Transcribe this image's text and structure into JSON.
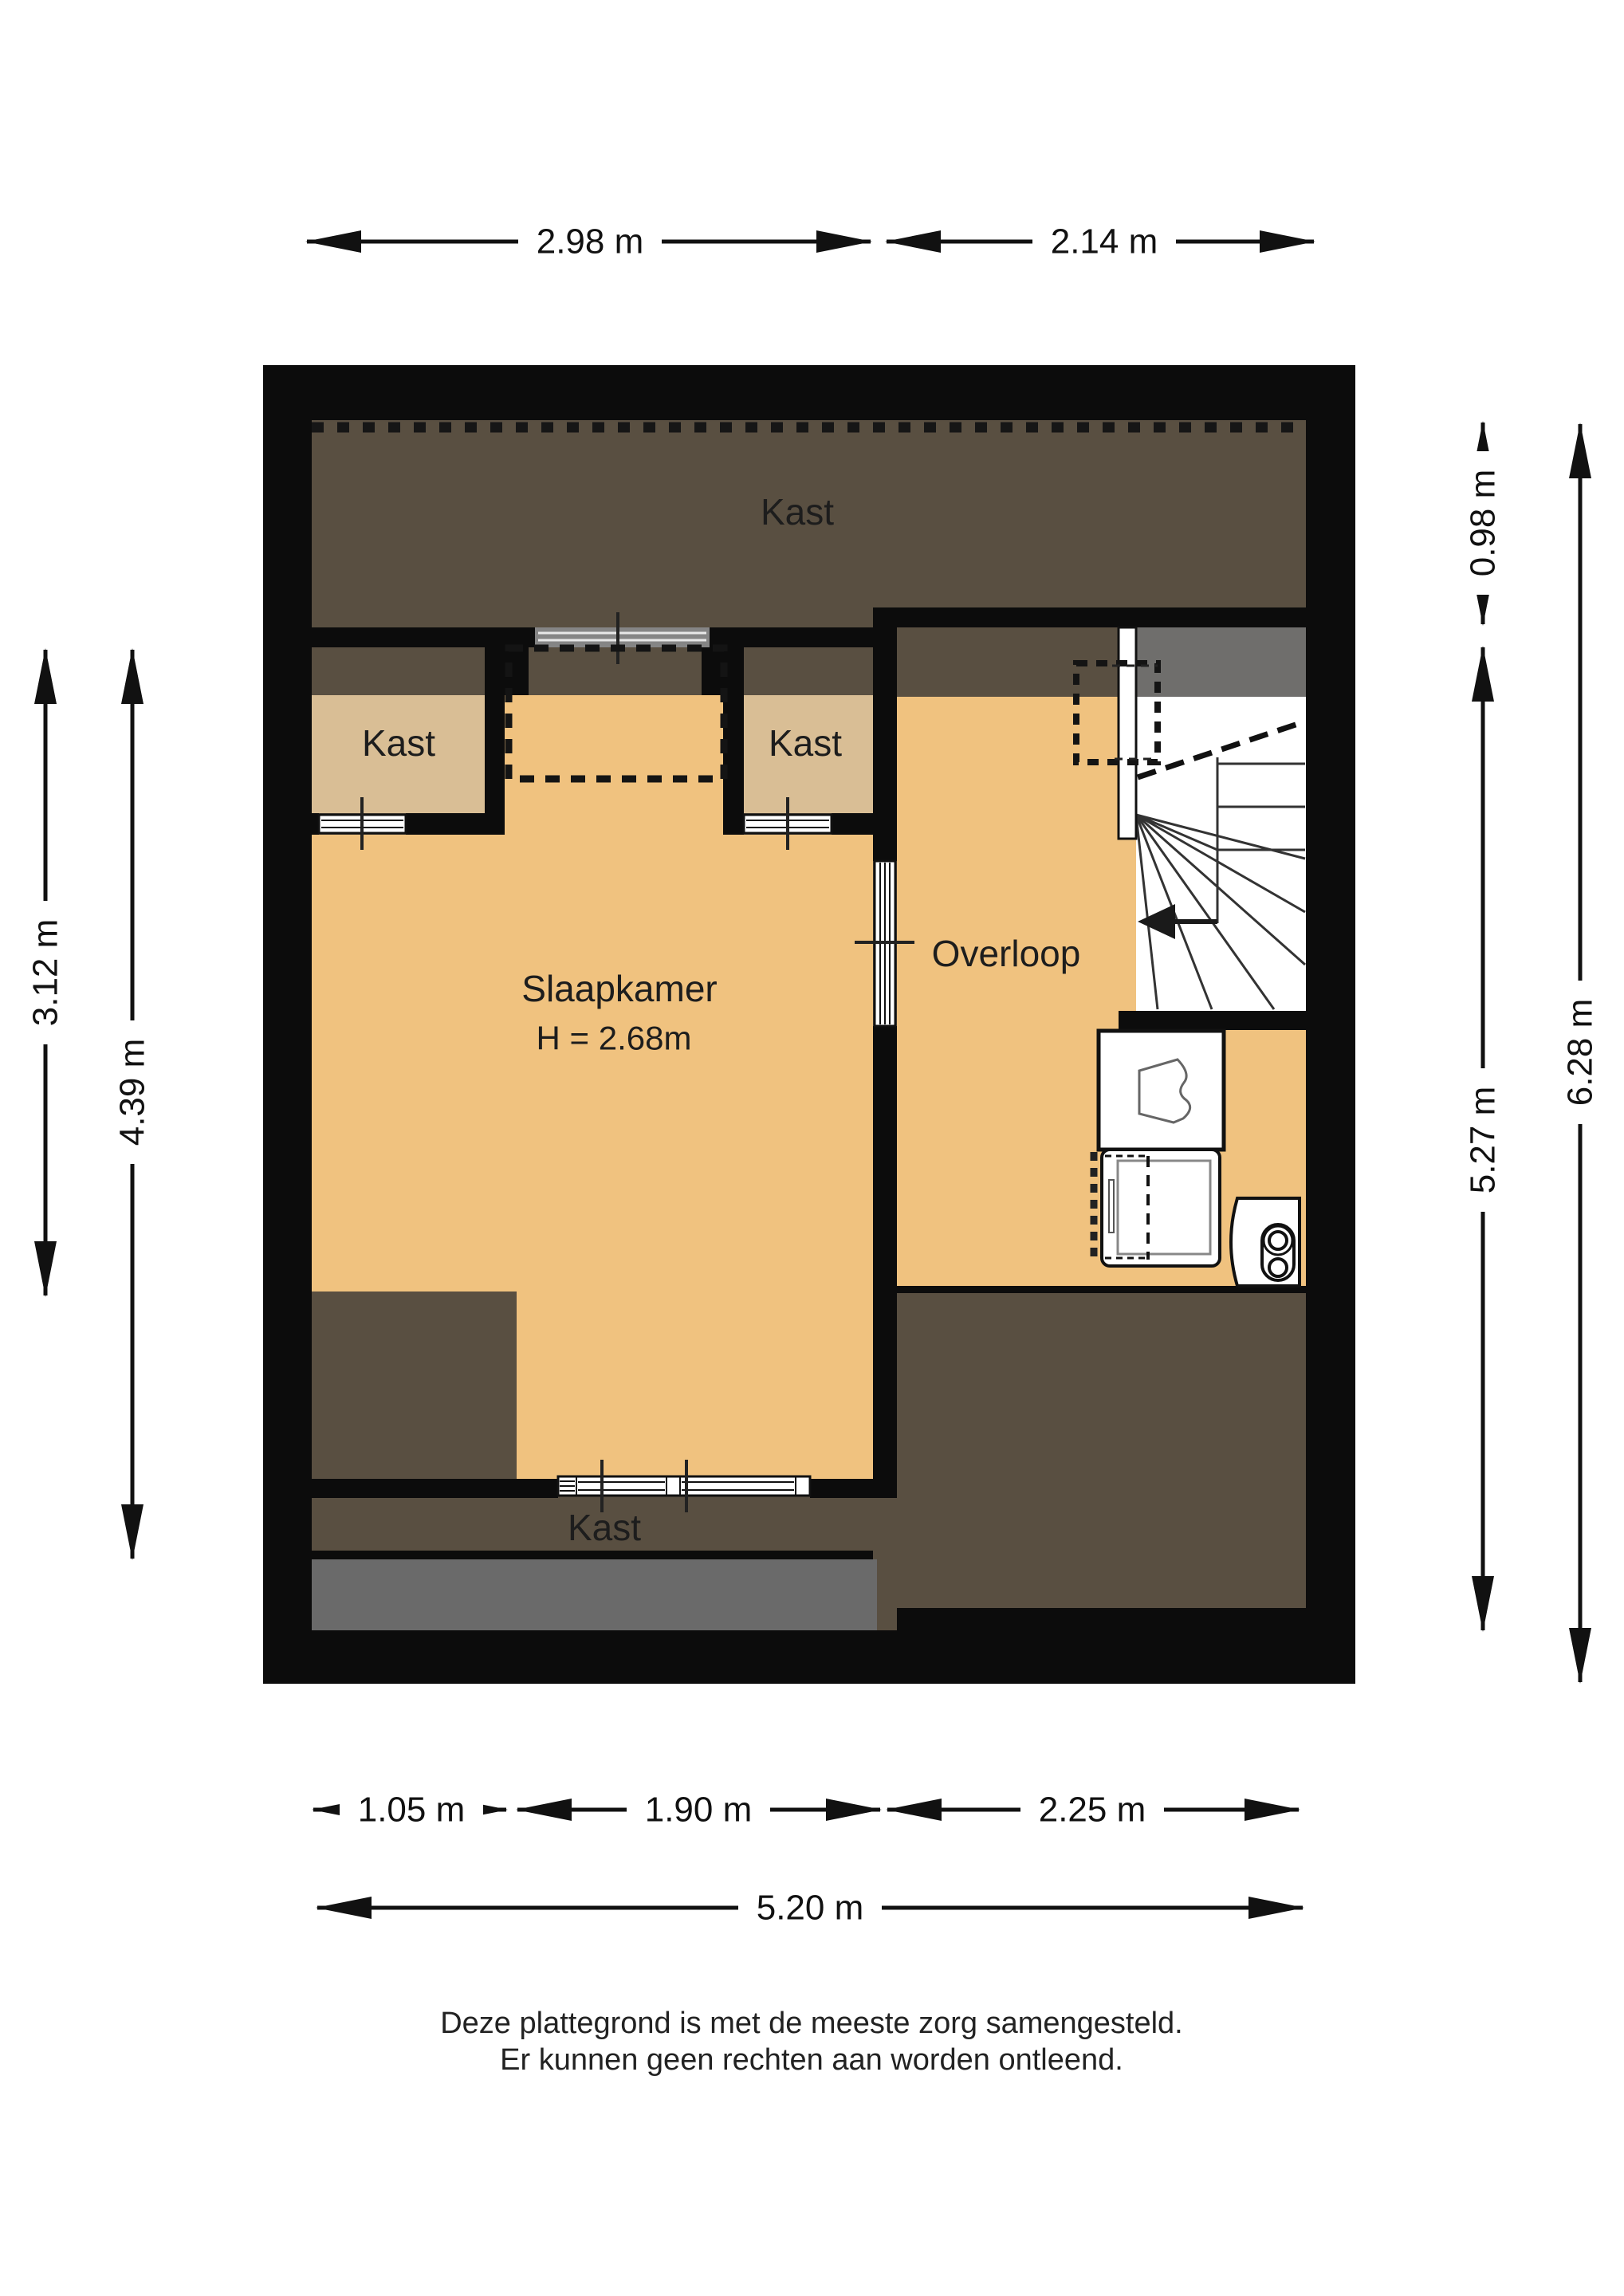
{
  "rooms": {
    "kast_top": "Kast",
    "kast_left": "Kast",
    "kast_right": "Kast",
    "kast_bottom": "Kast",
    "slaapkamer": "Slaapkamer",
    "slaapkamer_height": "H = 2.68m",
    "overloop": "Overloop"
  },
  "dimensions": {
    "top": [
      {
        "label": "2.98 m"
      },
      {
        "label": "2.14 m"
      }
    ],
    "bottom": [
      {
        "label": "1.05 m"
      },
      {
        "label": "1.90 m"
      },
      {
        "label": "2.25 m"
      }
    ],
    "bottom_total": "5.20 m",
    "left": [
      {
        "label": "3.12 m"
      },
      {
        "label": "4.39 m"
      }
    ],
    "right": [
      {
        "label": "0.98 m"
      },
      {
        "label": "5.27 m"
      },
      {
        "label": "6.28 m"
      }
    ]
  },
  "footer": {
    "line1": "Deze plattegrond is met de meeste zorg samengesteld.",
    "line2": "Er kunnen geen rechten aan worden ontleend."
  },
  "colors": {
    "floor": "#f0c27f",
    "closet": "#d9be95",
    "attic": "#594f41",
    "gray": "#6f6e6c",
    "gray2": "#6a6a6a",
    "wall": "#0c0c0c"
  }
}
